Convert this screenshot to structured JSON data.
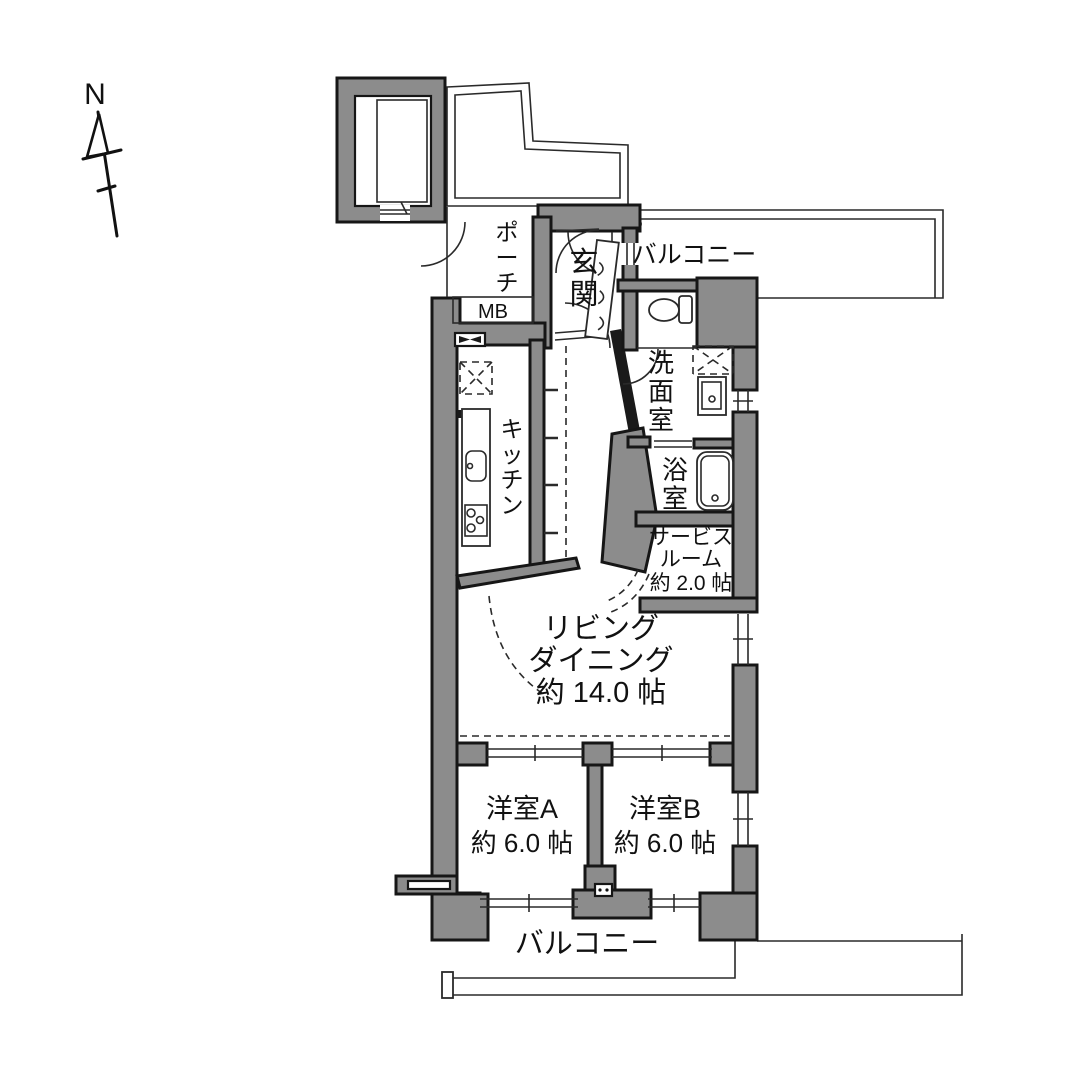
{
  "title": "マンション間取り図 (apartment floor plan)",
  "colors": {
    "background": "#ffffff",
    "wall_fill": "#8c8c8c",
    "wall_outline": "#161616",
    "thin_line": "#2a2a2a"
  },
  "labels": {
    "compass": "N",
    "porch": "ポーチ",
    "meter_box": "MB",
    "entrance": "玄関",
    "balcony_upper": "バルコニー",
    "kitchen": "キッチン",
    "washroom": "洗面室",
    "bathroom": "浴室",
    "service_room_line1": "サービス",
    "service_room_line2": "ルーム",
    "service_room_line3": "約 2.0 帖",
    "living_line1": "リビング",
    "living_line2": "ダイニング",
    "living_line3": "約 14.0 帖",
    "room_a_line1": "洋室A",
    "room_a_line2": "約 6.0 帖",
    "room_b_line1": "洋室B",
    "room_b_line2": "約 6.0 帖",
    "balcony_lower": "バルコニー"
  }
}
